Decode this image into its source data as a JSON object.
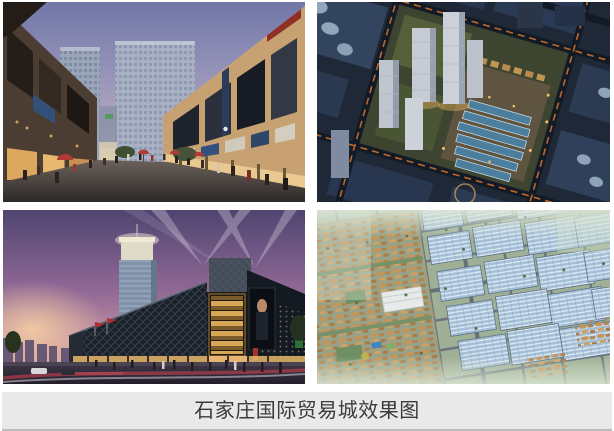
{
  "page": {
    "background": "#ffffff"
  },
  "collage": {
    "images": [
      {
        "name": "shopping-street-dusk-rendering"
      },
      {
        "name": "aerial-complex-night-rendering"
      },
      {
        "name": "trade-mall-night-rendering"
      },
      {
        "name": "masterplan-aerial-day-rendering"
      }
    ]
  },
  "caption": {
    "text": "石家庄国际贸易城效果图",
    "background": "#e9e9e9",
    "text_color": "#3b3b3b",
    "border_bottom_color": "#bdbdbd"
  }
}
